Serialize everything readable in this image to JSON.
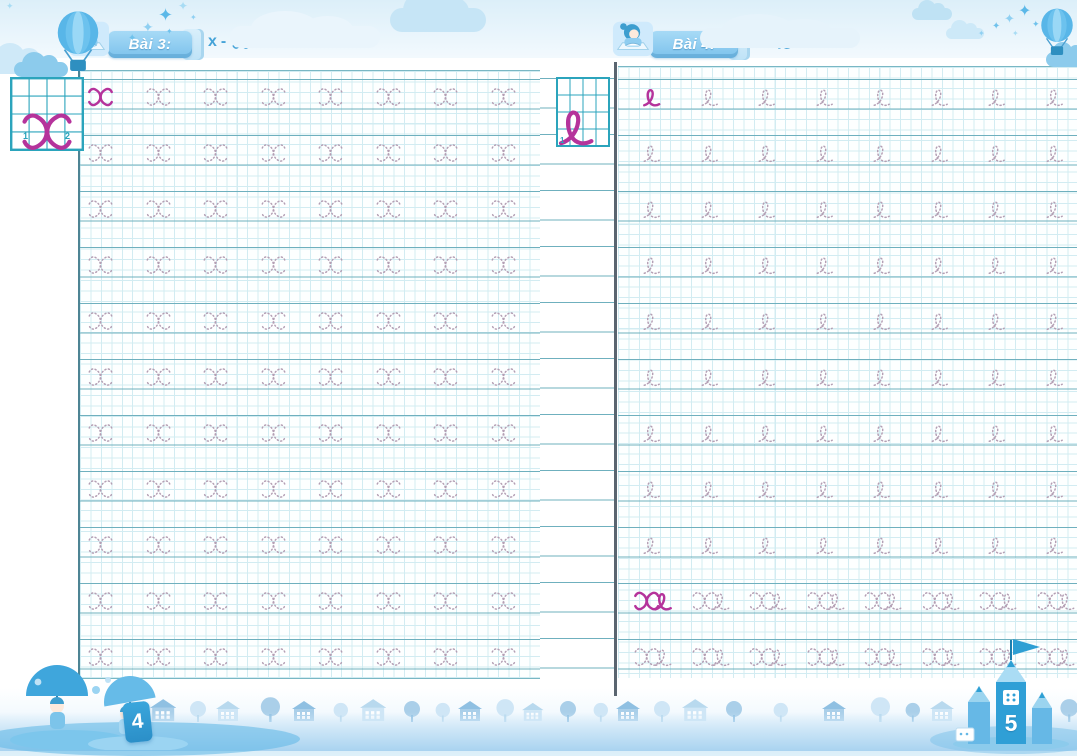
{
  "book": {
    "type": "handwriting-practice-workbook",
    "colors": {
      "accent_magenta": "#b5339b",
      "model_grid_teal": "#2ba4bc",
      "rule_line_teal": "#6fb0be",
      "banner_blue": "#7cc2ec",
      "header_text_blue": "#45a3d8",
      "decoration_sky_blue": "#58b6e8"
    },
    "icons": [
      "girl-reading-icon",
      "hot-air-balloon-icon",
      "cloud-icon",
      "sparkle-stars-icon",
      "house-icon",
      "tree-icon",
      "kids-with-umbrellas-illustration",
      "pencil-castle-illustration",
      "flag-icon"
    ]
  },
  "pages": [
    {
      "side": "left",
      "lesson_label": "Bài 3:",
      "letter_pair": {
        "print": "x",
        "separator": "-",
        "cursive": "x"
      },
      "page_number": "4",
      "model": {
        "letter": "x",
        "stroke_numbers": [
          "1",
          "2"
        ]
      },
      "practice_rows": [
        {
          "letter": "x",
          "count": 8,
          "first_solid": true
        },
        {
          "letter": "x",
          "count": 8,
          "first_solid": false
        },
        {
          "letter": "x",
          "count": 8,
          "first_solid": false
        },
        {
          "letter": "x",
          "count": 8,
          "first_solid": false
        },
        {
          "letter": "x",
          "count": 8,
          "first_solid": false
        },
        {
          "letter": "x",
          "count": 8,
          "first_solid": false
        },
        {
          "letter": "x",
          "count": 8,
          "first_solid": false
        },
        {
          "letter": "x",
          "count": 8,
          "first_solid": false
        },
        {
          "letter": "x",
          "count": 8,
          "first_solid": false
        },
        {
          "letter": "x",
          "count": 8,
          "first_solid": false
        },
        {
          "letter": "x",
          "count": 8,
          "first_solid": false
        }
      ]
    },
    {
      "side": "right",
      "lesson_label": "Bài 4:",
      "letter_pair": {
        "print": "e",
        "separator": "-",
        "cursive": "e"
      },
      "page_number": "5",
      "model": {
        "letter": "e",
        "stroke_numbers": [
          "1"
        ]
      },
      "practice_rows": [
        {
          "letter": "e",
          "count": 8,
          "first_solid": true
        },
        {
          "letter": "e",
          "count": 8,
          "first_solid": false
        },
        {
          "letter": "e",
          "count": 8,
          "first_solid": false
        },
        {
          "letter": "e",
          "count": 8,
          "first_solid": false
        },
        {
          "letter": "e",
          "count": 8,
          "first_solid": false
        },
        {
          "letter": "e",
          "count": 8,
          "first_solid": false
        },
        {
          "letter": "e",
          "count": 8,
          "first_solid": false
        },
        {
          "letter": "e",
          "count": 8,
          "first_solid": false
        },
        {
          "letter": "e",
          "count": 8,
          "first_solid": false
        },
        {
          "letter": "xe",
          "count": 8,
          "first_solid": true
        },
        {
          "letter": "xe",
          "count": 8,
          "first_solid": false
        }
      ]
    }
  ]
}
